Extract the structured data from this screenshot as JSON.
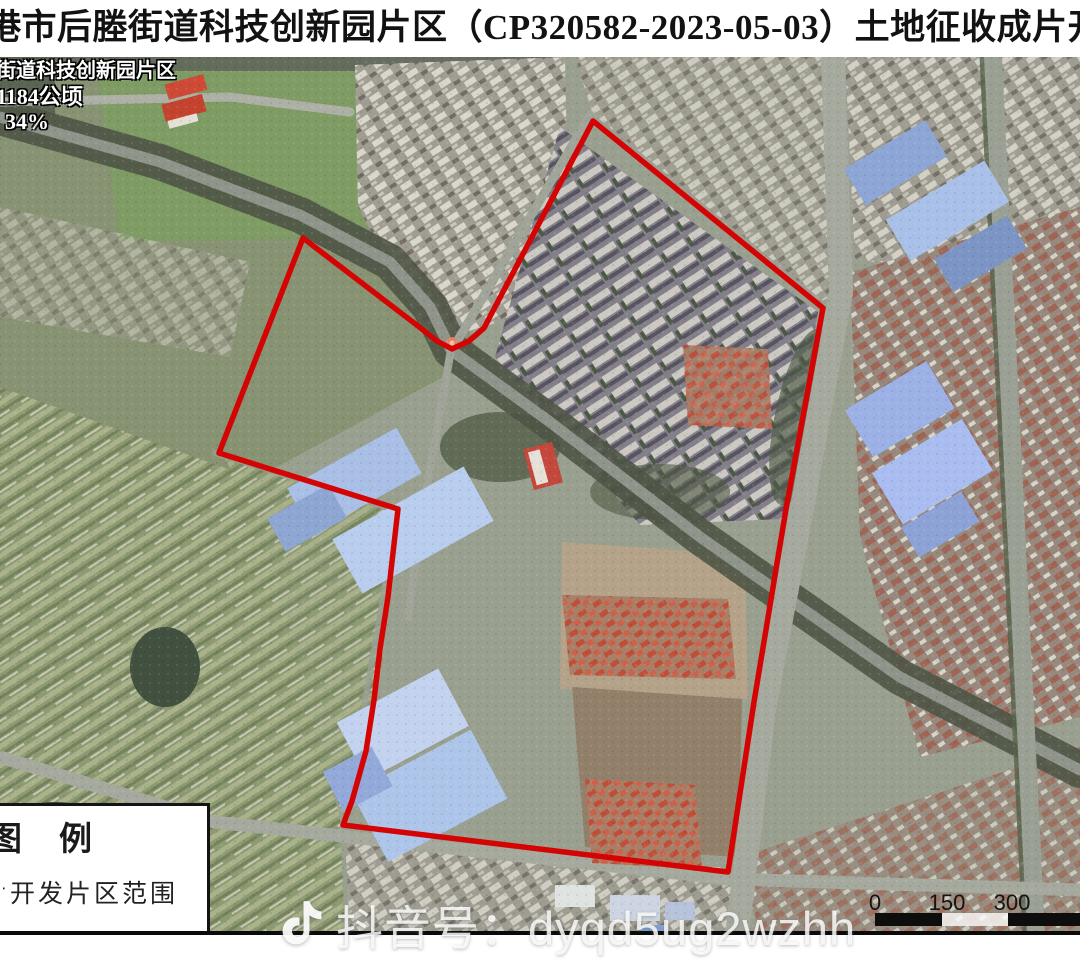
{
  "title": "港市后塍街道科技创新园片区（CP320582-2023-05-03）土地征收成片开发方",
  "map_overlay": {
    "line1": "街道科技创新园片区",
    "line2": "1184公顷",
    "line3": "34%"
  },
  "legend": {
    "title": "图　例",
    "item_cut_prefix": "片",
    "item_label": "开发片区范围"
  },
  "scale_bar": {
    "labels": [
      "0",
      "150",
      "300"
    ]
  },
  "watermark": {
    "icon": "tiktok-note-icon",
    "text": "抖音号：dyqd5ug2wzhh"
  },
  "colors": {
    "boundary": "#d40404",
    "title_text": "#121212"
  }
}
